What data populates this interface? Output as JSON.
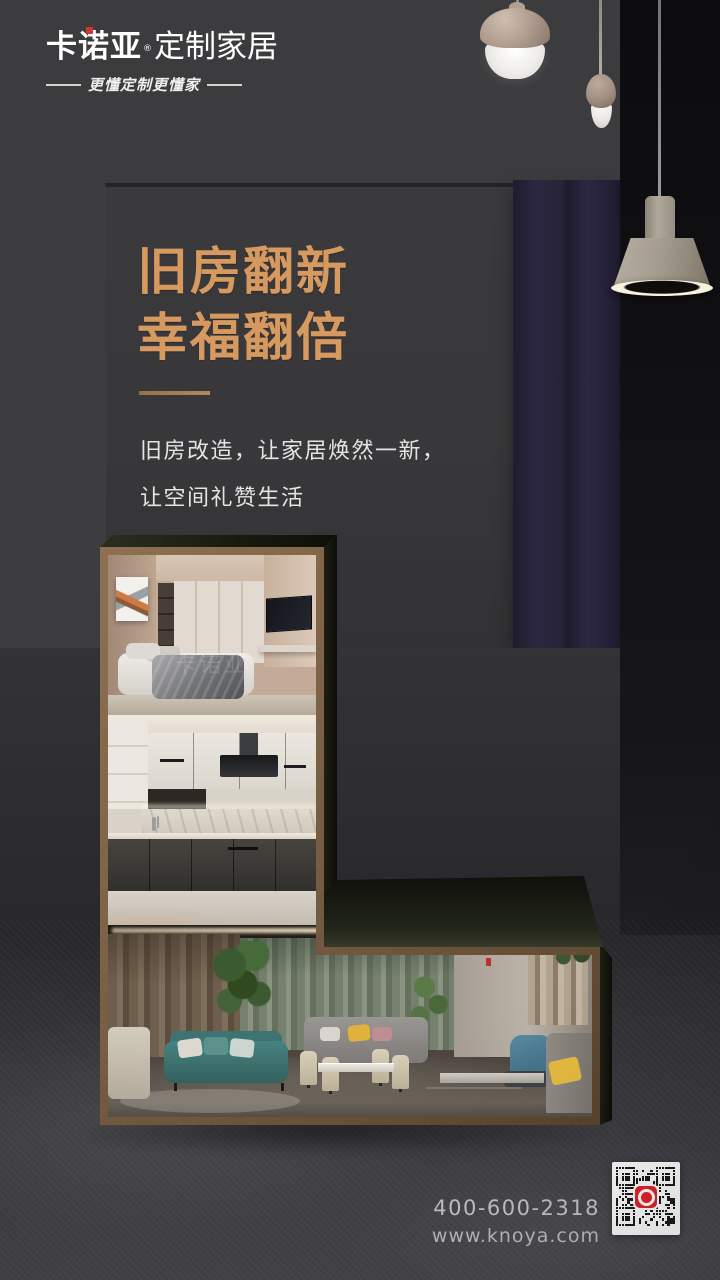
{
  "brand": {
    "name": "卡诺亚",
    "registered_mark": "®",
    "suffix": "定制家居",
    "tagline": "更懂定制更懂家",
    "red_accent": "#d0382e"
  },
  "hero": {
    "title_lines": [
      "旧房翻新",
      "幸福翻倍"
    ],
    "gold_color": "#d6995f",
    "subtitle_lines": [
      "旧房改造，让家居焕然一新，",
      "让空间礼赞生活"
    ]
  },
  "gallery": {
    "watermark": "卡诺亚",
    "frame_color": "#7c6245",
    "photos": [
      "bedroom",
      "kitchen",
      "living-room"
    ]
  },
  "contact": {
    "phone": "400-600-2318",
    "website": "www.knoya.com"
  },
  "qr": {
    "logo_color": "#e2242b"
  }
}
